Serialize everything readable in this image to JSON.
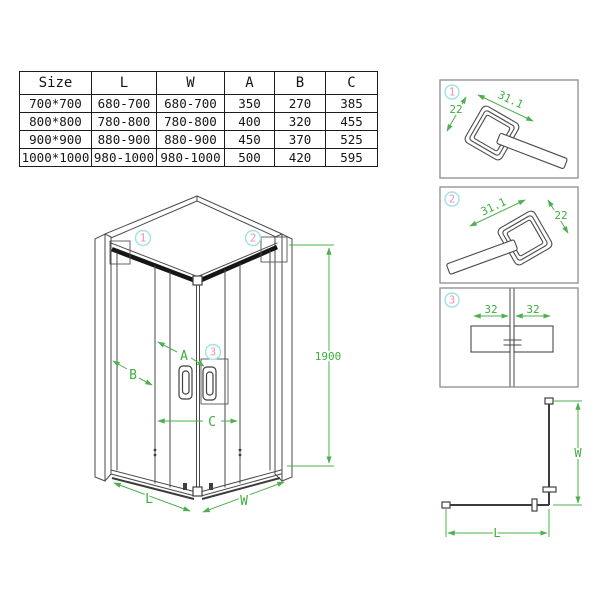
{
  "colors": {
    "annotation_green": "#4eb04e",
    "callout_pink": "#f590ae",
    "callout_cyan": "#9fe3e6",
    "line_dark": "#4a4a4a"
  },
  "table": {
    "headers": [
      "Size",
      "L",
      "W",
      "A",
      "B",
      "C"
    ],
    "rows": [
      [
        "700*700",
        "680-700",
        "680-700",
        "350",
        "270",
        "385"
      ],
      [
        "800*800",
        "780-800",
        "780-800",
        "400",
        "320",
        "455"
      ],
      [
        "900*900",
        "880-900",
        "880-900",
        "450",
        "370",
        "525"
      ],
      [
        "1000*1000",
        "980-1000",
        "980-1000",
        "500",
        "420",
        "595"
      ]
    ]
  },
  "main": {
    "callout_1": "1",
    "callout_2": "2",
    "callout_3": "3",
    "label_a": "A",
    "label_b": "B",
    "label_c": "C",
    "label_l": "L",
    "label_w": "W",
    "dim_height": "1900"
  },
  "details": [
    {
      "number": "1",
      "dim_top": "31.1",
      "dim_side": "22"
    },
    {
      "number": "2",
      "dim_top": "31.1",
      "dim_side": "22"
    },
    {
      "number": "3",
      "dim_left": "32",
      "dim_right": "32"
    }
  ],
  "plan": {
    "label_w": "W",
    "label_l": "L"
  }
}
